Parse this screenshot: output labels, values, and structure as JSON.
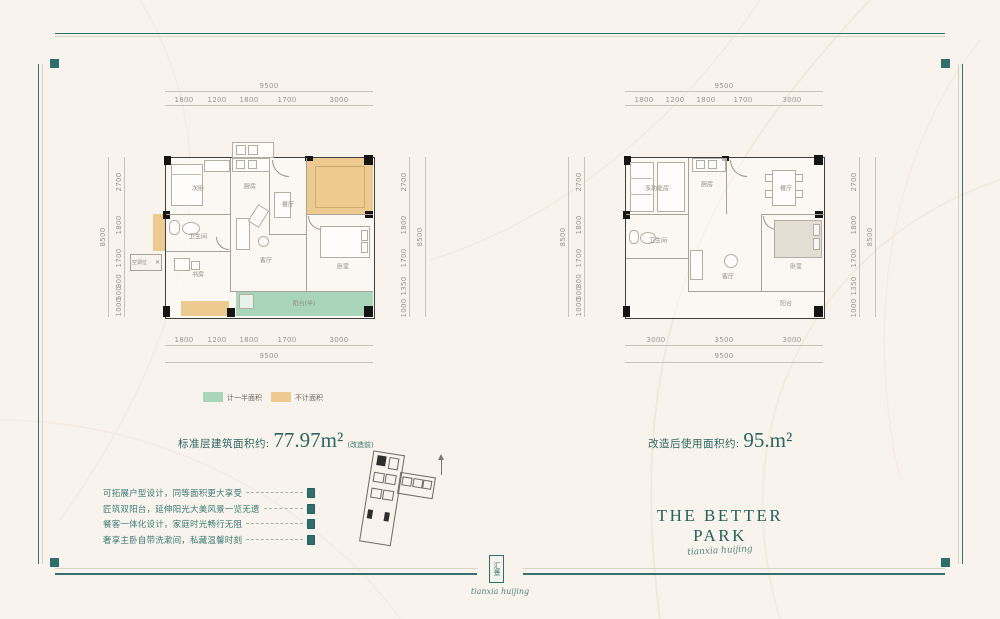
{
  "brand": {
    "name": "THE BETTER PARK",
    "script": "tianxia huijing",
    "seal_text": "汇景"
  },
  "legend": {
    "half_label": "计一半面积",
    "excluded_label": "不计面积"
  },
  "areas": {
    "left_label": "标准层建筑面积约:",
    "left_value": "77.97m²",
    "left_note": "(改造前)",
    "right_label": "改造后使用面积约:",
    "right_value": "95.m²"
  },
  "features": [
    "可拓展户型设计，同等面积更大享受",
    "匠筑双阳台，延伸阳光大美风景一览无遗",
    "餐客一体化设计，家庭时光畅行无阻",
    "奢享主卧自带洗漱间，私藏温馨时刻"
  ],
  "plans": {
    "left": {
      "rooms": {
        "bed2": "次卧",
        "kitchen": "厨房",
        "dining": "餐厅",
        "bath": "卫生间",
        "study": "书房",
        "living": "客厅",
        "bed1": "卧室",
        "balcony": "阳台(半)",
        "ac": "空调位"
      },
      "dims": {
        "top_total": "9500",
        "top_segments": [
          "1800",
          "1200",
          "1800",
          "1700",
          "3000"
        ],
        "bottom_total": "9500",
        "bottom_segments": [
          "1800",
          "1200",
          "1800",
          "1700",
          "3000"
        ],
        "left_total": "8500",
        "left_segments": [
          "2700",
          "1800",
          "1700",
          "800",
          "500",
          "1000"
        ],
        "right_total": "8500",
        "right_segments": [
          "2700",
          "1800",
          "1700",
          "1350",
          "1000"
        ]
      }
    },
    "right": {
      "rooms": {
        "multi": "多功能房",
        "bath": "卫生间",
        "kitchen": "厨房",
        "dining": "餐厅",
        "living": "客厅",
        "bed": "卧室",
        "balcony": "阳台"
      },
      "dims": {
        "top_total": "9500",
        "top_segments": [
          "1800",
          "1200",
          "1800",
          "1700",
          "3000"
        ],
        "bottom_total": "9500",
        "bottom_segments": [
          "3000",
          "3500",
          "3000"
        ],
        "left_total": "8500",
        "left_segments": [
          "2700",
          "1800",
          "1700",
          "800",
          "500",
          "1000"
        ],
        "right_total": "8500",
        "right_segments": [
          "2700",
          "1800",
          "1700",
          "1350",
          "1000"
        ]
      }
    }
  },
  "colors": {
    "accent": "#2e6e6b",
    "half_area": "#a9d5ba",
    "excluded_area": "#ecca90",
    "background": "#f8f3ec"
  }
}
